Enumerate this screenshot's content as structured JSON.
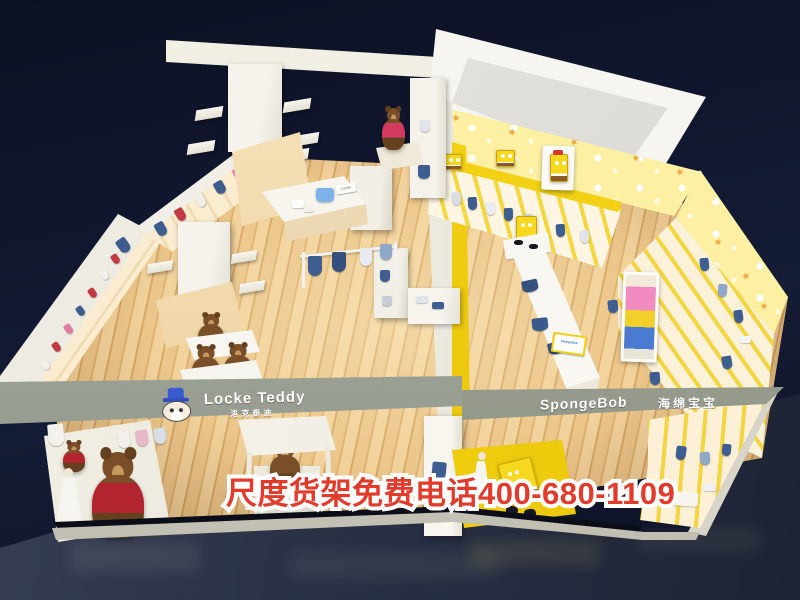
{
  "signs": {
    "locke_teddy": {
      "name_en": "Locke Teddy",
      "name_cn": "洛克泰迪"
    },
    "spongebob": {
      "name_en": "SpongeBob",
      "name_cn": "海绵宝宝"
    }
  },
  "hotline": {
    "text": "尺度货架免费电话400-680-1109"
  },
  "icons": {
    "star": "★"
  },
  "colors": {
    "background_navy": "#11172b",
    "plaza_floor": "#2c3346",
    "wood_light": "#eac88c",
    "wood_dark": "#cf9b55",
    "fixture_white": "#f4f1e8",
    "sign_band_grey": "#9ba195",
    "hotline_red": "#e23a2b",
    "hotline_outline": "#ffffff",
    "brand_yellow": "#f2d014",
    "wallpaper_yellow": "#fdf2a6",
    "star_orange": "#f0a43c",
    "denim_blue": "#3d5d8f",
    "bear_brown": "#7a4f28",
    "sweater_red": "#b22430",
    "sponge_yellow": "#f4d214"
  }
}
